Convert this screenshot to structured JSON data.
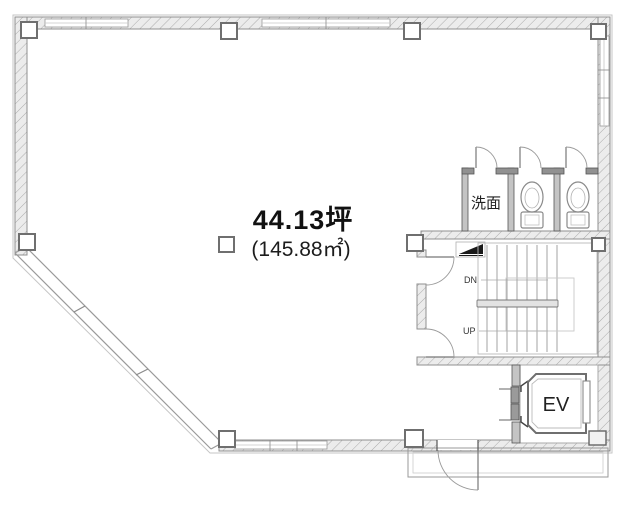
{
  "plan": {
    "area_tsubo": "44.13坪",
    "area_sqm": "(145.88㎡)",
    "washroom_label": "洗面",
    "elevator_label": "EV",
    "stair_down_label": "DN",
    "stair_up_label": "UP",
    "colors": {
      "wall_fill": "#ececec",
      "wall_hatch": "#ababab",
      "wall_outline": "#8f8f8f",
      "partition": "#c4c4c4",
      "fixture_line": "#8a8a8a",
      "text": "#111111"
    }
  }
}
